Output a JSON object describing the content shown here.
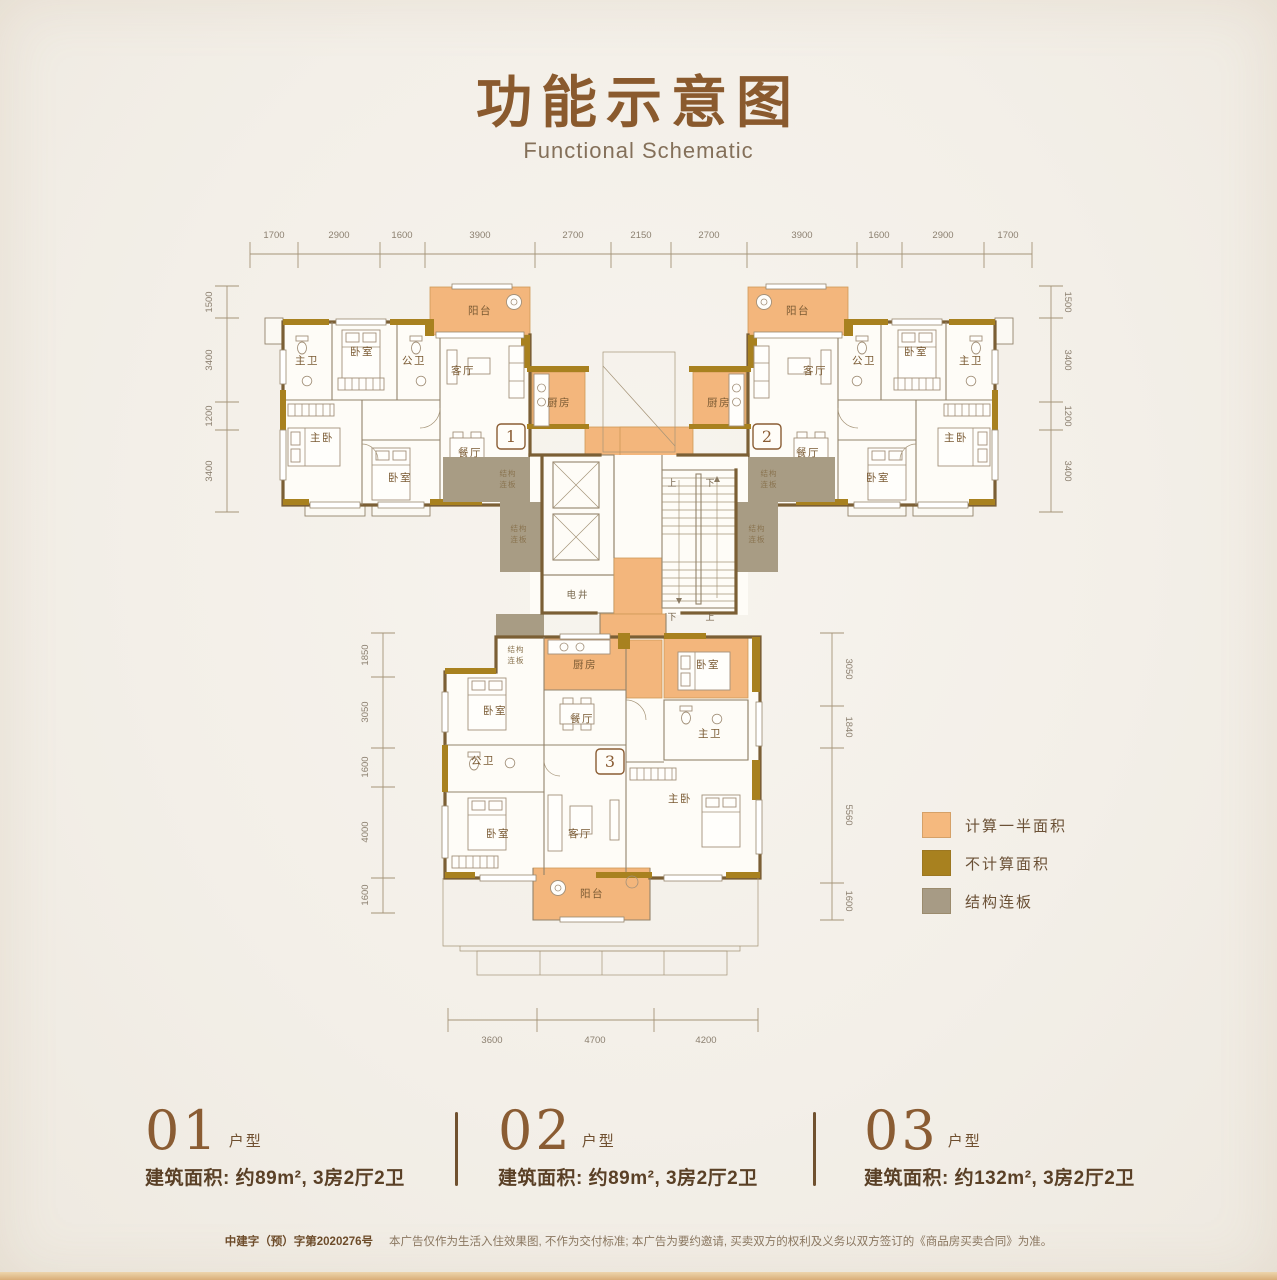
{
  "page": {
    "title": "功能示意图",
    "subtitle": "Functional Schematic",
    "disclaimer_permit": "中建字（预）字第2020276号",
    "disclaimer_text": "本广告仅作为生活入住效果图, 不作为交付标准; 本广告为要约邀请, 买卖双方的权利及义务以双方签订的《商品房买卖合同》为准。"
  },
  "colors": {
    "title_brown": "#8a5a2e",
    "half_area_orange": "#f5b97e",
    "not_counted_gold": "#a8811f",
    "slab_gray": "#a79b85",
    "wall_brown": "#7b5f35",
    "background_cream": "#f3efe8"
  },
  "rooms": {
    "balcony": "阳台",
    "living": "客厅",
    "dining": "餐厅",
    "kitchen": "厨房",
    "bedroom": "卧室",
    "master_bedroom": "主卧",
    "master_bath": "主卫",
    "public_bath": "公卫",
    "shaft": "电井",
    "slab_line1": "结构",
    "slab_line2": "连板",
    "up": "上",
    "down": "下"
  },
  "badges": {
    "u1": "1",
    "u2": "2",
    "u3": "3"
  },
  "dims": {
    "top": [
      "1700",
      "2900",
      "1600",
      "3900",
      "2700",
      "2150",
      "2700",
      "3900",
      "1600",
      "2900",
      "1700"
    ],
    "left_upper": [
      "1500",
      "3400",
      "1200",
      "3400"
    ],
    "right_upper": [
      "1500",
      "3400",
      "1200",
      "3400"
    ],
    "left_lower": [
      "1850",
      "3050",
      "1600",
      "4000",
      "1600"
    ],
    "right_lower": [
      "3050",
      "1840",
      "5560",
      "1600"
    ],
    "bottom": [
      "3600",
      "4700",
      "4200"
    ]
  },
  "legend": {
    "items": [
      {
        "label": "计算一半面积",
        "color": "#f5b97e"
      },
      {
        "label": "不计算面积",
        "color": "#a8811f"
      },
      {
        "label": "结构连板",
        "color": "#a79b85"
      }
    ]
  },
  "units": [
    {
      "number": "01",
      "type_suffix": "户型",
      "area_line": "建筑面积: 约89m², 3房2厅2卫"
    },
    {
      "number": "02",
      "type_suffix": "户型",
      "area_line": "建筑面积: 约89m², 3房2厅2卫"
    },
    {
      "number": "03",
      "type_suffix": "户型",
      "area_line": "建筑面积: 约132m², 3房2厅2卫"
    }
  ]
}
